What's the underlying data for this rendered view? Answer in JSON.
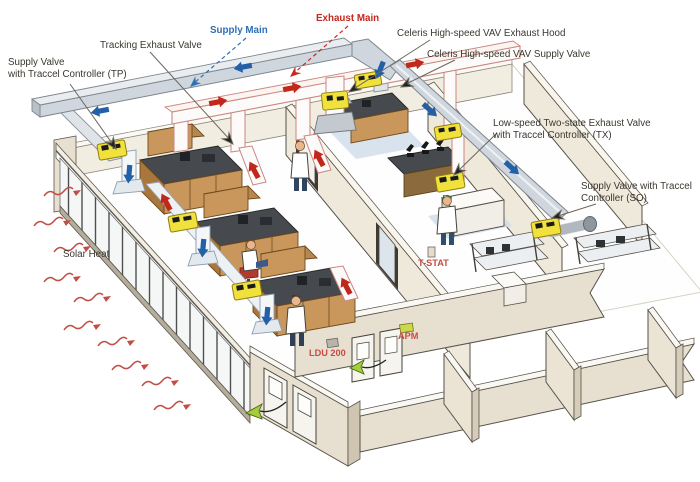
{
  "figure": {
    "type": "isometric laboratory HVAC airflow diagram",
    "background": "#ffffff",
    "colors": {
      "supply_duct": "#ccd2d9",
      "exhaust_duct_outline": "#c98680",
      "supply_arrow_blue": "#2460a8",
      "exhaust_arrow_red": "#c2271c",
      "valve_yellow": "#f1e13c",
      "wall_beige": "#e7e0d1",
      "bench_wood": "#c8955c",
      "counter_dark": "#45484c",
      "green_airflow_arrow": "#a6ce39",
      "solar_heat_red": "#c14e44",
      "label_black": "#3a372e",
      "label_blue": "#2e6fb5",
      "label_red": "#c4281f"
    },
    "labels": {
      "supply_valve_tp": "Supply Valve\nwith Traccel Controller (TP)",
      "tracking_exhaust_valve": "Tracking Exhaust Valve",
      "supply_main": "Supply Main",
      "exhaust_main": "Exhaust Main",
      "celeris_exhaust_hood": "Celeris High-speed VAV Exhaust Hood",
      "celeris_supply_valve": "Celeris High-speed VAV Supply Valve",
      "low_speed_two_state": "Low-speed Two-state Exhaust Valve\nwith Traccel Controller (TX)",
      "supply_valve_so": "Supply Valve with Traccel\nController (SO)",
      "solar_heat": "Solar Heat",
      "t_stat": "T-STAT",
      "ldu_200": "LDU 200",
      "apm": "APM"
    }
  }
}
